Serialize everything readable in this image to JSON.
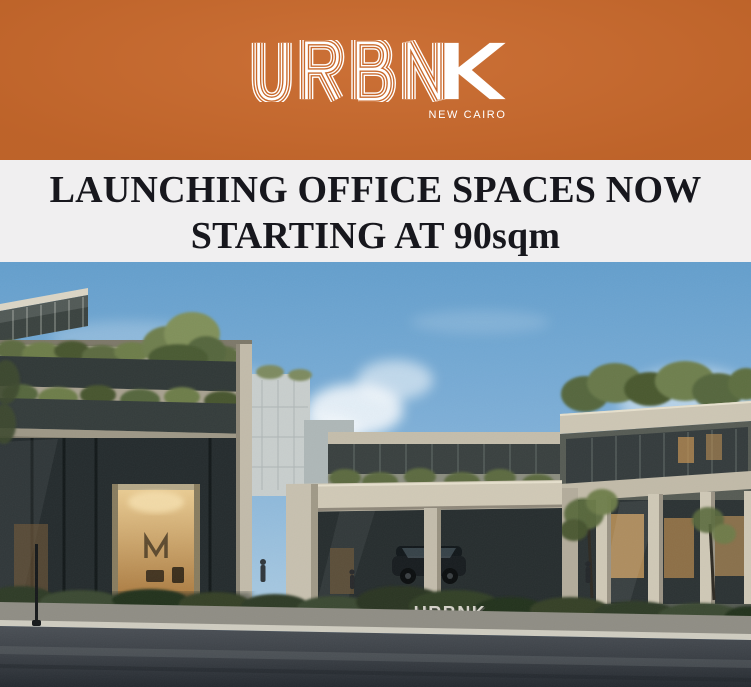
{
  "meta": {
    "flyer_title": "URBNK New Cairo — Launching Office Spaces"
  },
  "theme": {
    "banner_orange": "#c9692c",
    "headline_bg": "#f0eff0",
    "headline_text": "#17171d",
    "logo_white": "#ffffff"
  },
  "brand": {
    "wordmark": "URBNK",
    "wordmark_outline_letters": "URBN",
    "wordmark_solid_letter": "K",
    "tagline": "NEW CAIRO"
  },
  "headline": {
    "line1": "LAUNCHING OFFICE SPACES NOW",
    "line2": "STARTING AT 90sqm"
  },
  "hero": {
    "alt": "Architectural rendering of the URBNK New Cairo office complex: stone and glass buildings with rooftop greenery, warm lit lobbies, a central gateway, hedges and a road in front under a blue sky",
    "signage_text": "URBNK",
    "colors": {
      "sky_top": "#649fcd",
      "sky_bottom": "#bad3e6",
      "stone": "#cdc6b4",
      "glass": "#2b3233",
      "warm_light": "#c89a5b",
      "greenery": "#5f7044",
      "road": "#3a3f45"
    }
  }
}
